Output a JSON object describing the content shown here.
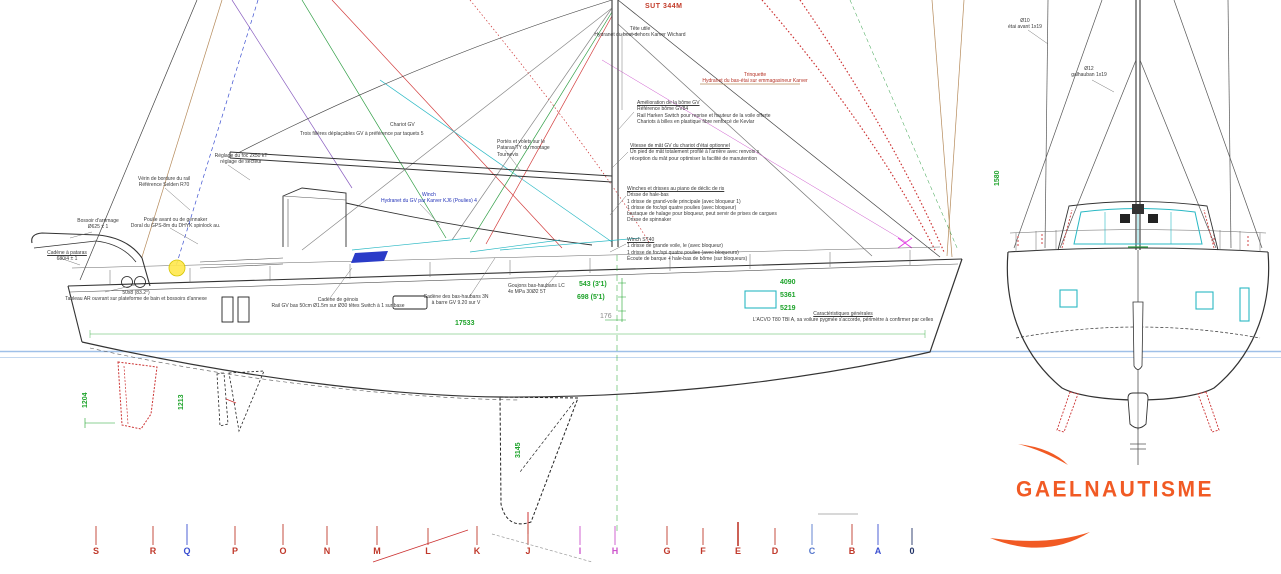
{
  "logo": {
    "text": "GAELNAUTISME",
    "color": "#f15a24"
  },
  "title_red": "SUT 344M",
  "stations": [
    {
      "label": "S",
      "color": "#c0392b"
    },
    {
      "label": "R",
      "color": "#c0392b"
    },
    {
      "label": "Q",
      "color": "#3b4fd0"
    },
    {
      "label": "P",
      "color": "#c0392b"
    },
    {
      "label": "O",
      "color": "#c0392b"
    },
    {
      "label": "N",
      "color": "#c0392b"
    },
    {
      "label": "M",
      "color": "#c0392b"
    },
    {
      "label": "L",
      "color": "#c0392b"
    },
    {
      "label": "K",
      "color": "#c0392b"
    },
    {
      "label": "J",
      "color": "#c0392b"
    },
    {
      "label": "I",
      "color": "#cc55cc"
    },
    {
      "label": "H",
      "color": "#cc55cc"
    },
    {
      "label": "G",
      "color": "#c0392b"
    },
    {
      "label": "F",
      "color": "#c0392b"
    },
    {
      "label": "E",
      "color": "#c0392b"
    },
    {
      "label": "D",
      "color": "#c0392b"
    },
    {
      "label": "C",
      "color": "#5577cc"
    },
    {
      "label": "B",
      "color": "#c0392b"
    },
    {
      "label": "A",
      "color": "#3b4fd0"
    },
    {
      "label": "0",
      "color": "#223366"
    }
  ],
  "dims": {
    "loa": "17533",
    "fb1": "4090",
    "fb2": "5361",
    "fb3": "5219",
    "draft_a": "543 (3'1)",
    "draft_b": "698 (5'1)",
    "draft_c": "176",
    "keel_span": "3145",
    "rud_a": "1204",
    "rud_b": "1213",
    "front_h": "1580"
  },
  "annotations": {
    "masthead": {
      "lines": [
        "Tête utile",
        "Hydranet du bout-dehors Karver Wichard"
      ]
    },
    "trinquette": {
      "lines": [
        "Trinquette",
        "Hydranet du bas-étai sur emmagasineur Karver"
      ]
    },
    "rail": {
      "lines": [
        "Amélioration de la bôme GV",
        "Référence bôme GV84",
        "Rail Harken Switch pour reprise et hauteur de la voile offerte",
        "Chariots à billes en plastique fibre renforcé de Kevlar"
      ]
    },
    "mastfoot": {
      "lines": [
        "Vitesse de mât GV du chariot d'étai optionnel",
        "Un pied de mât totalement profilé à l'arrière avec renvois s",
        "réception du mât pour optimiser la facilité de manutention"
      ]
    },
    "piano": {
      "lines": [
        "Winches et drisses au piano de déclic de ris",
        "Drisse de hale-bas",
        "1 drisse de grand-voile principale (avec bloqueur 1)",
        "1 drisse de foc/spi quatre poulies (avec bloqueur)",
        "bastaque de halage pour bloqueur, peut servir de prises de cargues",
        "Drisse de spinnaker"
      ]
    },
    "winch": {
      "lines": [
        "Winch ST40",
        "1 drisse de grande voile, le (avec bloqueur)",
        "1 drisse de foc/spi quatre poulies (avec bloqueurs)",
        "Écoute de barque + hale-bas de bôme (sur bloqueurs)"
      ]
    },
    "arch": {
      "lines": [
        "Bossoir d'arrimage",
        "Ø625 ± 1"
      ]
    },
    "pataras": {
      "lines": [
        "Cadène à pataras",
        "680/4 ± 1"
      ]
    },
    "transom": {
      "lines": [
        "50x8 (83.2°)",
        "Tableau AR ouvrant sur plateforme de bain et bossoirs d'annexe"
      ]
    },
    "foc": {
      "lines": [
        "Réglage du foc 2x50 kT",
        "réglage de secteur"
      ]
    },
    "verin": {
      "lines": [
        "Vérin de bordure du rail",
        "Référence Selden R70"
      ]
    },
    "poulie": {
      "lines": [
        "Poulie avant ou de gennaker",
        "Doral du GPS-8m du DHYK spinlock au."
      ]
    },
    "filieres": {
      "lines": [
        "Trois filières déplaçables GV à préférence par taquets 5"
      ]
    },
    "chariot": {
      "lines": [
        "Chariot GV"
      ]
    },
    "winch_blue": {
      "lines": [
        "Winch",
        "Hydranet du GV par Karver KJ6 (Poulies) 4"
      ]
    },
    "genois": {
      "lines": [
        "Cadène de génois",
        "Rail GV bas 50cm Ø1.5m sur Ø30 têtes Switch à 1 sur base"
      ]
    },
    "haubans": {
      "lines": [
        "Cadène des bas-haubans 3N",
        "à barre GV 9.20 sur V"
      ]
    },
    "goujons": {
      "lines": [
        "Goujons bas-haubans LC",
        "4x MPa 30Ø2 5T"
      ]
    },
    "caracteristiques": {
      "lines": [
        "Caractéristiques générales",
        "L'ACVO T80 TBI A, sa voilure pygmée s'accorde, périmètre à confirmer par celles"
      ]
    },
    "pataras_ty": {
      "lines": [
        "Portés et volets sur le",
        "Pataras/TY du montage",
        "Tournevis"
      ]
    },
    "front_d1": {
      "lines": [
        "Ø10",
        "étai avant 1x19"
      ]
    },
    "front_d2": {
      "lines": [
        "Ø12",
        "galhauban 1x19"
      ]
    }
  }
}
